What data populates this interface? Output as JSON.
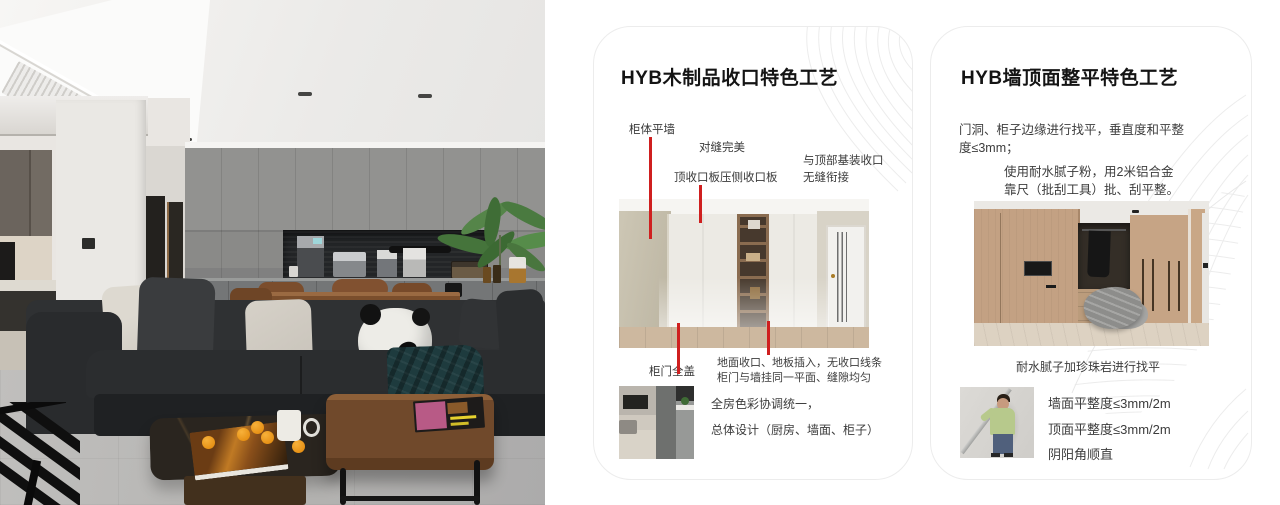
{
  "colors": {
    "accent_red": "#cf1f1f",
    "card_border": "#ececec",
    "title_text": "#141414",
    "body_text": "#3c3c3c"
  },
  "card_wood": {
    "title": "HYB木制品收口特色工艺",
    "callouts": {
      "cabinet_flat_wall": "柜体平墙",
      "perfect_seam": "对缝完美",
      "top_closing_panel": "顶收口板压侧收口板",
      "ceiling_joint_line1": "与顶部基装收口",
      "ceiling_joint_line2": "无缝衔接",
      "full_cover_door": "柜门全盖"
    },
    "notes": {
      "line1": "地面收口、地板插入，无收口线条",
      "line2": "柜门与墙挂同一平面、缝隙均匀"
    },
    "summary": {
      "line1": "全房色彩协调统一，",
      "line2": "总体设计（厨房、墙面、柜子）"
    }
  },
  "card_wall": {
    "title": "HYB墙顶面整平特色工艺",
    "para_leveling": {
      "line1": "门洞、柜子边缘进行找平，垂直度和平整",
      "line2": "度≤3mm；"
    },
    "para_putty": {
      "line1": "使用耐水腻子粉，用2米铝合金",
      "line2": "靠尺（批刮工具）批、刮平整。"
    },
    "caption": "耐水腻子加珍珠岩进行找平",
    "specs": [
      "墙面平整度≤3mm/2m",
      "顶面平整度≤3mm/2m",
      "阴阳角顺直"
    ]
  }
}
